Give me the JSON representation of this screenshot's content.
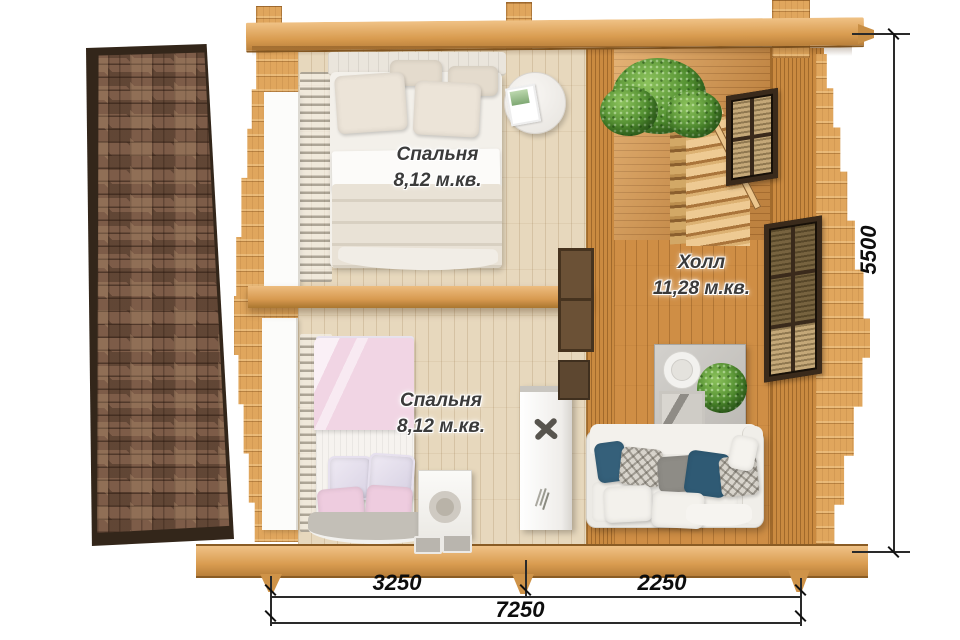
{
  "plan": {
    "rooms": [
      {
        "id": "bedroom-1",
        "name": "Спальня",
        "area": "8,12 м.кв."
      },
      {
        "id": "bedroom-2",
        "name": "Спальня",
        "area": "8,12 м.кв."
      },
      {
        "id": "hall",
        "name": "Холл",
        "area": "11,28 м.кв."
      }
    ],
    "dimensions": {
      "side_height": "5500",
      "bottom_left": "3250",
      "bottom_right": "2250",
      "bottom_total": "7250"
    },
    "colors": {
      "log_wood": "#d79a55",
      "hall_floor": "#cf8e45",
      "bedroom_floor": "#e7d8bd",
      "roof_shingle": "#7d5c48",
      "roof_trim": "#33261a",
      "pillow_accent": "#35607a",
      "plant_green": "#4c8a2d",
      "bed_pink": "#f1d5e4"
    }
  }
}
